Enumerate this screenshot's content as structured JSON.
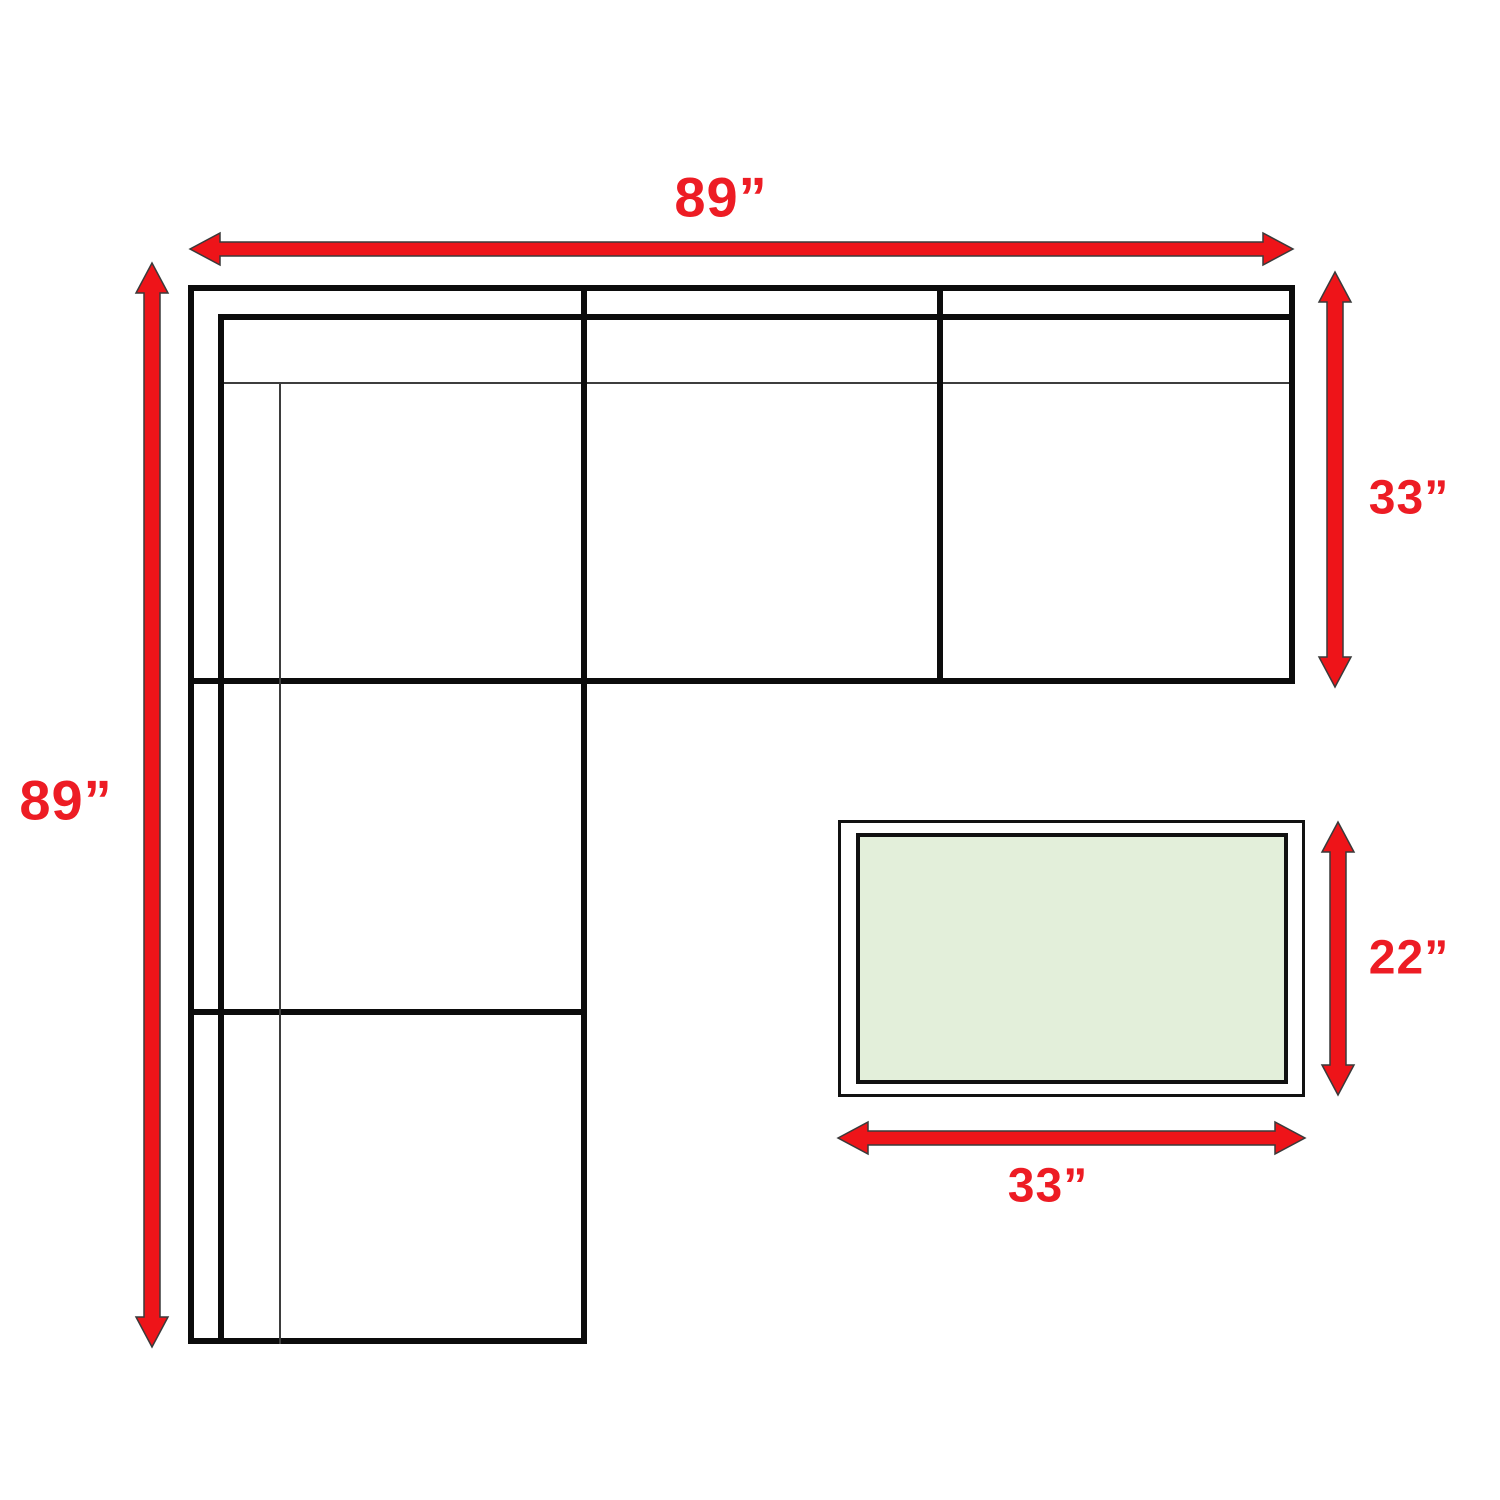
{
  "colors": {
    "arrow_red": "#ee1419",
    "label_red": "#ed1c24",
    "outline_black": "#0c0c0c",
    "table_top_green": "#e3efda",
    "background": "#ffffff"
  },
  "dimensions": {
    "sofa_width": "89”",
    "sofa_height": "89”",
    "sofa_depth": "33”",
    "table_depth": "22”",
    "table_width": "33”"
  }
}
